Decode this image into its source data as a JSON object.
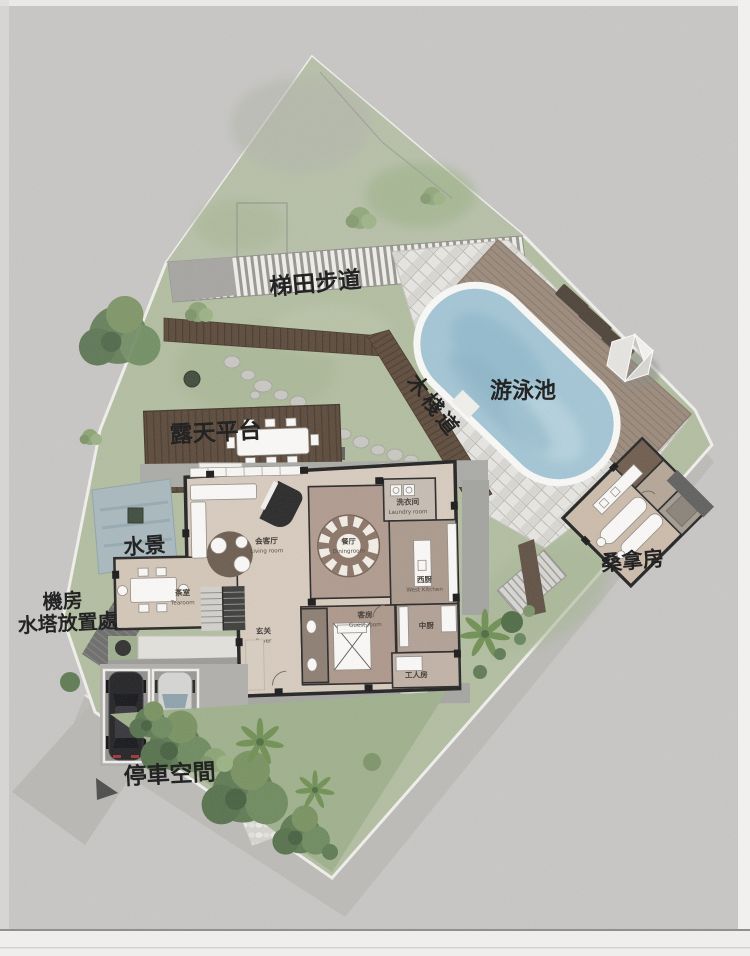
{
  "plan": {
    "type": "residential villa site plan (ground floor + landscape)",
    "labels": {
      "terrace_path": "梯田步道",
      "boardwalk": "木棧道",
      "pool": "游泳池",
      "open_deck": "露天平台",
      "water_feature": "水景",
      "plant_room": "機房",
      "water_tank_area": "水塔放置處",
      "sauna": "桑拿房",
      "parking": "停車空間"
    },
    "rooms": {
      "living": {
        "cn": "会客厅",
        "en": "Living room"
      },
      "dining": {
        "cn": "餐厅",
        "en": "Diningroom"
      },
      "laundry": {
        "cn": "洗衣间",
        "en": "Laundry room"
      },
      "west_kitchen": {
        "cn": "西厨",
        "en": "West Kitchen"
      },
      "foyer": {
        "cn": "玄关",
        "en": "Foyer"
      },
      "tearoom": {
        "cn": "茶室",
        "en": "Tearoom"
      },
      "guest": {
        "cn": "客房",
        "en": "Guest room"
      },
      "chinese_kitchen": {
        "cn": "中厨"
      },
      "staff_room": {
        "cn": "工人房"
      },
      "stairs_up": "UP"
    },
    "colors": {
      "background": "#c8c7c5",
      "road": "#bcbbb7",
      "lawn": "#b2bea0",
      "garden": "#9fb18c",
      "dark_wood": "#5a4839",
      "pool_deck_wood": "#9b8a7b",
      "pool_water": "#a3c6d6",
      "stone_tile": "#e8e7e3",
      "floor_beige": "#d8ccbe",
      "floor_brown": "#b09a8e",
      "water_feature": "#a9b9be",
      "label_text": "#161616"
    }
  }
}
